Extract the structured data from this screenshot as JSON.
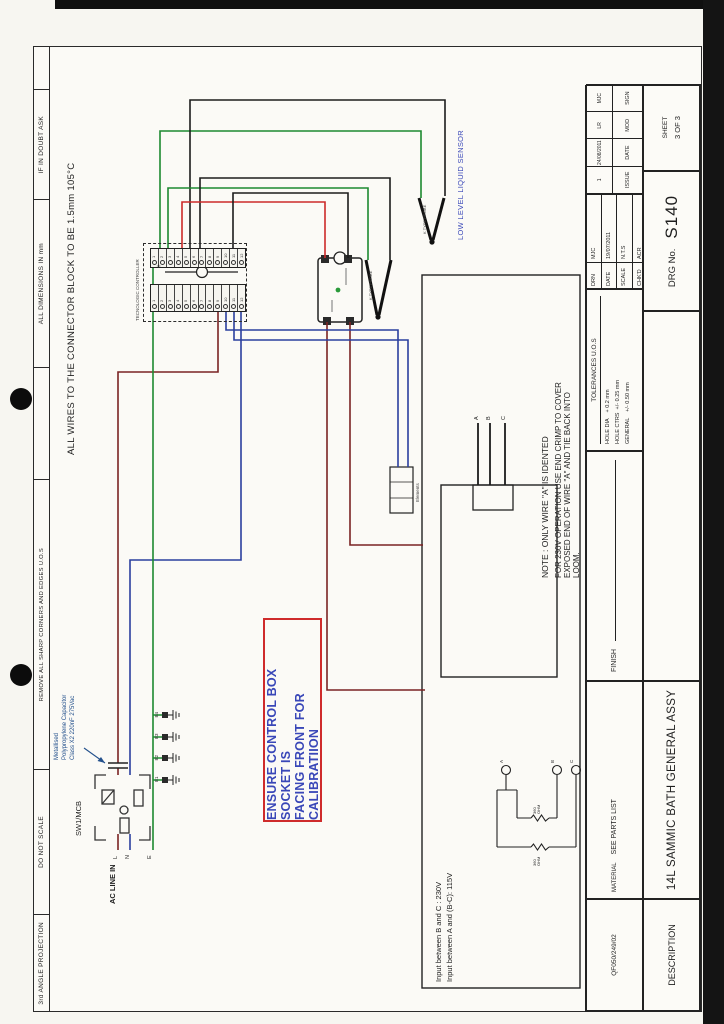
{
  "margin": {
    "cells": [
      "IF IN DOUBT ASK",
      "ALL DIMENSIONS IN mm",
      "REMOVE ALL SHARP CORNERS AND EDGES U.O.S",
      "DO NOT SCALE",
      "3rd ANGLE PROJECTION"
    ]
  },
  "title_block": {
    "doc_code": "QF050/249/02",
    "material_label": "MATERIAL",
    "material": "SEE PARTS LIST",
    "finish_label": "FINISH",
    "tolerances_title": "TOLERANCES U.O.S",
    "tolerances": [
      "HOLE DIA    + 0.2 mm",
      "HOLE CTRS  +/- 0.25 mm",
      "GENERAL    +/- 0.50 mm"
    ],
    "info_rows": [
      {
        "label": "DRN",
        "value": "MJC"
      },
      {
        "label": "DATE",
        "value": "19/07/2011"
      },
      {
        "label": "SCALE",
        "value": "N.T.S"
      },
      {
        "label": "CHK'D",
        "value": "ACR"
      }
    ],
    "issue_cols": [
      {
        "value": "1",
        "header": "ISSUE"
      },
      {
        "value": "24/08/2011",
        "header": "DATE"
      },
      {
        "value": "LR",
        "header": "MOD"
      },
      {
        "value": "MJC",
        "header": "SIGN"
      }
    ],
    "description_label": "DESCRIPTION",
    "description": "14L SAMMIC BATH  GENERAL ASSY",
    "drg_label": "DRG No.",
    "drg_no": "S140",
    "sheet_label": "SHEET",
    "sheet_value": "3  OF  3"
  },
  "drawing": {
    "wires_note": "ALL WIRES TO THE CONNECTOR BLOCK TO BE 1.5mm 105°C",
    "controller_label": "TECNOLOGIC CONTROLLER",
    "strip_a": [
      "1",
      "2",
      "3",
      "4",
      "5",
      "6",
      "7",
      "8",
      "9",
      "10",
      "11",
      "12"
    ],
    "strip_b": [
      "1",
      "2",
      "3",
      "4",
      "5",
      "6",
      "7",
      "8",
      "9",
      "10",
      "11",
      "12"
    ],
    "plus": "+",
    "minus": "−",
    "warning_line1": "ENSURE CONTROL BOX SOCKET IS",
    "warning_line2": "FACING FRONT FOR CALIBRATIION",
    "note_title": "NOTE : ONLY WIRE \"A\" IS IDENTED",
    "note_lines": [
      "FOR 230V OPERATION USE END CRIMP TO COVER",
      "EXPOSED END OF WIRE \"A\" AND TIE BACK INTO",
      "LOOM."
    ],
    "sensor_label": "LOW LEVEL LIQUID SENSOR",
    "probe1_label": "K TYPE PROBE",
    "probe2_label": "K TYPE PROBE",
    "sw_label": "SW1/MCB",
    "cap_lines": [
      "Metallised",
      "Polypropylene Capacitor",
      "Class X2 220nF 275Vac"
    ],
    "ac_label": "AC LINE IN",
    "line_l": "L",
    "line_n": "N",
    "line_e": "E",
    "earth_labels": [
      "E1",
      "E2",
      "E3",
      "E4"
    ],
    "elements_label": "Elements",
    "heater_labels": [
      "A",
      "B",
      "C"
    ],
    "resistor_labels": [
      "A",
      "B",
      "C"
    ],
    "input_note_1": "Input between B and C : 230V",
    "input_note_2": "Input between A and (B-C): 115V",
    "resistor1": "360 OHM",
    "resistor2": "360 OHM"
  }
}
